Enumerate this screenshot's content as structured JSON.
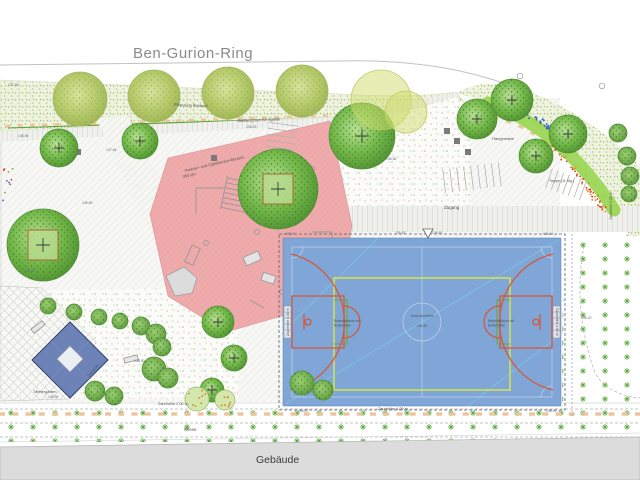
{
  "street_label": "Ben-Gurion-Ring",
  "building_label": "Gebäude",
  "colors": {
    "court_blue": "#7fa6d6",
    "court_orange": "#d4583a",
    "court_yellow": "#d8e44c",
    "court_green": "#6aa832",
    "playground_red": "#efabab",
    "diamond_blue": "#6d83b8",
    "building_gray": "#dcdcdc",
    "fence_green": "#5a9e3c",
    "paving_tick": "#ecc49c",
    "band_green": "#97d44e",
    "bed_blue": "#3a66c4",
    "bed_red": "#d44020",
    "bed_orange": "#e07828",
    "lawn_green": "#58a838",
    "label_gray": "#555555",
    "elevation_gray": "#667077"
  },
  "playground": {
    "label_line1": "Parkour- und Calisthenics-Bereich",
    "label_line2": "350 qm"
  },
  "labels": [
    {
      "t": "Pflanzung Bestand",
      "x": 174,
      "y": 106,
      "s": 4,
      "rot": 2
    },
    {
      "t": "Ballfangzaun für Spieler",
      "x": 238,
      "y": 122,
      "s": 4,
      "rot": -2
    },
    {
      "t": "Zugang",
      "x": 444,
      "y": 209,
      "s": 4.5,
      "rot": 0
    },
    {
      "t": "Hängematte",
      "x": 492,
      "y": 140,
      "s": 4,
      "rot": 0
    },
    {
      "t": "Wiese",
      "x": 184,
      "y": 431,
      "s": 4.5,
      "rot": 0
    },
    {
      "t": "Zaunhöhe 2.00 m",
      "x": 158,
      "y": 405,
      "s": 3.8,
      "rot": 0
    },
    {
      "t": "Zaunhöhe 4.00 m",
      "x": 378,
      "y": 410,
      "s": 3.8,
      "rot": 0
    },
    {
      "t": "Mietergärten",
      "x": 34,
      "y": 393,
      "s": 4,
      "rot": 0
    },
    {
      "t": "Treppe (11 Stg.)",
      "x": 549,
      "y": 182,
      "s": 3.5,
      "rot": 0
    },
    {
      "t": "Trampolin",
      "x": 88,
      "y": 378,
      "s": 3.8,
      "rot": -48
    },
    {
      "t": "Parkour- und Calisthenics-Bereich",
      "x": 185,
      "y": 172,
      "s": 4,
      "rot": -13
    },
    {
      "t": "350 qm",
      "x": 183,
      "y": 178,
      "s": 4,
      "rot": -13
    },
    {
      "t": "Kleinspielfeld",
      "x": 422,
      "y": 317,
      "s": 3.8,
      "rot": 0,
      "anchor": "middle"
    },
    {
      "t": "136.45",
      "x": 422,
      "y": 327,
      "s": 3.4,
      "rot": 0,
      "anchor": "middle"
    },
    {
      "t": "Basketballkorb mit",
      "x": 334,
      "y": 322,
      "s": 3.2,
      "rot": 0
    },
    {
      "t": "Bodenhülse",
      "x": 334,
      "y": 326.5,
      "s": 3.2,
      "rot": 0
    },
    {
      "t": "Basketballkorb mit",
      "x": 488,
      "y": 322,
      "s": 3.2,
      "rot": 0
    },
    {
      "t": "Bodenhülse",
      "x": 488,
      "y": 326.5,
      "s": 3.2,
      "rot": 0
    },
    {
      "t": "Zaunhöhe 4.00 m",
      "x": 289,
      "y": 322,
      "s": 3.6,
      "rot": -90,
      "anchor": "middle"
    },
    {
      "t": "Zaunhöhe 4.00 m",
      "x": 556,
      "y": 322,
      "s": 3.6,
      "rot": 90,
      "anchor": "middle"
    },
    {
      "t": "Zaunhöhe 2.30 m",
      "x": 612,
      "y": 206,
      "s": 3.5,
      "rot": -90,
      "anchor": "middle"
    }
  ],
  "elevations": [
    {
      "t": "136.06",
      "x": 18,
      "y": 137
    },
    {
      "t": "137.48",
      "x": 106,
      "y": 151
    },
    {
      "t": "136.65",
      "x": 82,
      "y": 204
    },
    {
      "t": "136.43",
      "x": 246,
      "y": 128
    },
    {
      "t": "136.56",
      "x": 386,
      "y": 160
    },
    {
      "t": "136.74",
      "x": 285,
      "y": 235
    },
    {
      "t": "136.63",
      "x": 395,
      "y": 234
    },
    {
      "t": "136.65",
      "x": 432,
      "y": 234
    },
    {
      "t": "135.41",
      "x": 543,
      "y": 235
    },
    {
      "t": "136.19",
      "x": 581,
      "y": 319
    },
    {
      "t": "136.36",
      "x": 48,
      "y": 398
    },
    {
      "t": "135.05",
      "x": 24,
      "y": 272
    },
    {
      "t": "136.30",
      "x": 134,
      "y": 362
    },
    {
      "t": "136.07",
      "x": 298,
      "y": 412
    },
    {
      "t": "136.40",
      "x": 546,
      "y": 412
    },
    {
      "t": "137.95",
      "x": 8,
      "y": 86
    }
  ],
  "street_trees": [
    {
      "x": 80,
      "y": 99,
      "r": 27
    },
    {
      "x": 154,
      "y": 96,
      "r": 26
    },
    {
      "x": 228,
      "y": 93,
      "r": 26
    },
    {
      "x": 302,
      "y": 91,
      "r": 26
    }
  ],
  "crown_overlays": [
    {
      "x": 381,
      "y": 100,
      "r": 30
    },
    {
      "x": 406,
      "y": 112,
      "r": 21
    }
  ],
  "site_trees": [
    {
      "x": 43,
      "y": 245,
      "r": 36,
      "cross": true,
      "pit": true
    },
    {
      "x": 59,
      "y": 148,
      "r": 19,
      "cross": true,
      "pit": false
    },
    {
      "x": 140,
      "y": 141,
      "r": 18,
      "cross": true,
      "pit": false
    },
    {
      "x": 278,
      "y": 189,
      "r": 40,
      "cross": true,
      "pit": true
    },
    {
      "x": 362,
      "y": 136,
      "r": 33,
      "cross": true,
      "pit": false
    },
    {
      "x": 477,
      "y": 119,
      "r": 20,
      "cross": true,
      "pit": false
    },
    {
      "x": 512,
      "y": 100,
      "r": 21,
      "cross": true,
      "pit": false
    },
    {
      "x": 568,
      "y": 134,
      "r": 19,
      "cross": true,
      "pit": false
    },
    {
      "x": 536,
      "y": 156,
      "r": 17,
      "cross": true,
      "pit": false
    },
    {
      "x": 218,
      "y": 322,
      "r": 16,
      "cross": true,
      "pit": false
    },
    {
      "x": 234,
      "y": 358,
      "r": 13,
      "cross": true,
      "pit": false
    },
    {
      "x": 212,
      "y": 390,
      "r": 12,
      "cross": true,
      "pit": false
    }
  ],
  "shrubs": [
    {
      "x": 48,
      "y": 306,
      "r": 8
    },
    {
      "x": 74,
      "y": 312,
      "r": 8
    },
    {
      "x": 99,
      "y": 317,
      "r": 8
    },
    {
      "x": 120,
      "y": 321,
      "r": 8
    },
    {
      "x": 141,
      "y": 326,
      "r": 9
    },
    {
      "x": 156,
      "y": 334,
      "r": 10
    },
    {
      "x": 162,
      "y": 347,
      "r": 9
    },
    {
      "x": 154,
      "y": 369,
      "r": 12
    },
    {
      "x": 168,
      "y": 378,
      "r": 10
    },
    {
      "x": 95,
      "y": 391,
      "r": 10
    },
    {
      "x": 114,
      "y": 396,
      "r": 9
    },
    {
      "x": 302,
      "y": 383,
      "r": 12
    },
    {
      "x": 323,
      "y": 390,
      "r": 10
    },
    {
      "x": 618,
      "y": 133,
      "r": 9
    },
    {
      "x": 627,
      "y": 156,
      "r": 9
    },
    {
      "x": 630,
      "y": 176,
      "r": 9
    },
    {
      "x": 629,
      "y": 194,
      "r": 8
    }
  ],
  "planting_circles": [
    {
      "x": 197,
      "y": 399,
      "r": 12
    },
    {
      "x": 225,
      "y": 400,
      "r": 10
    }
  ],
  "benches": [
    {
      "x": 38,
      "y": 327,
      "rot": -38
    },
    {
      "x": 131,
      "y": 359,
      "rot": -15
    }
  ],
  "squares": [
    {
      "x": 447,
      "y": 131
    },
    {
      "x": 457,
      "y": 141
    },
    {
      "x": 468,
      "y": 152
    },
    {
      "x": 78,
      "y": 152
    },
    {
      "x": 214,
      "y": 158
    }
  ]
}
